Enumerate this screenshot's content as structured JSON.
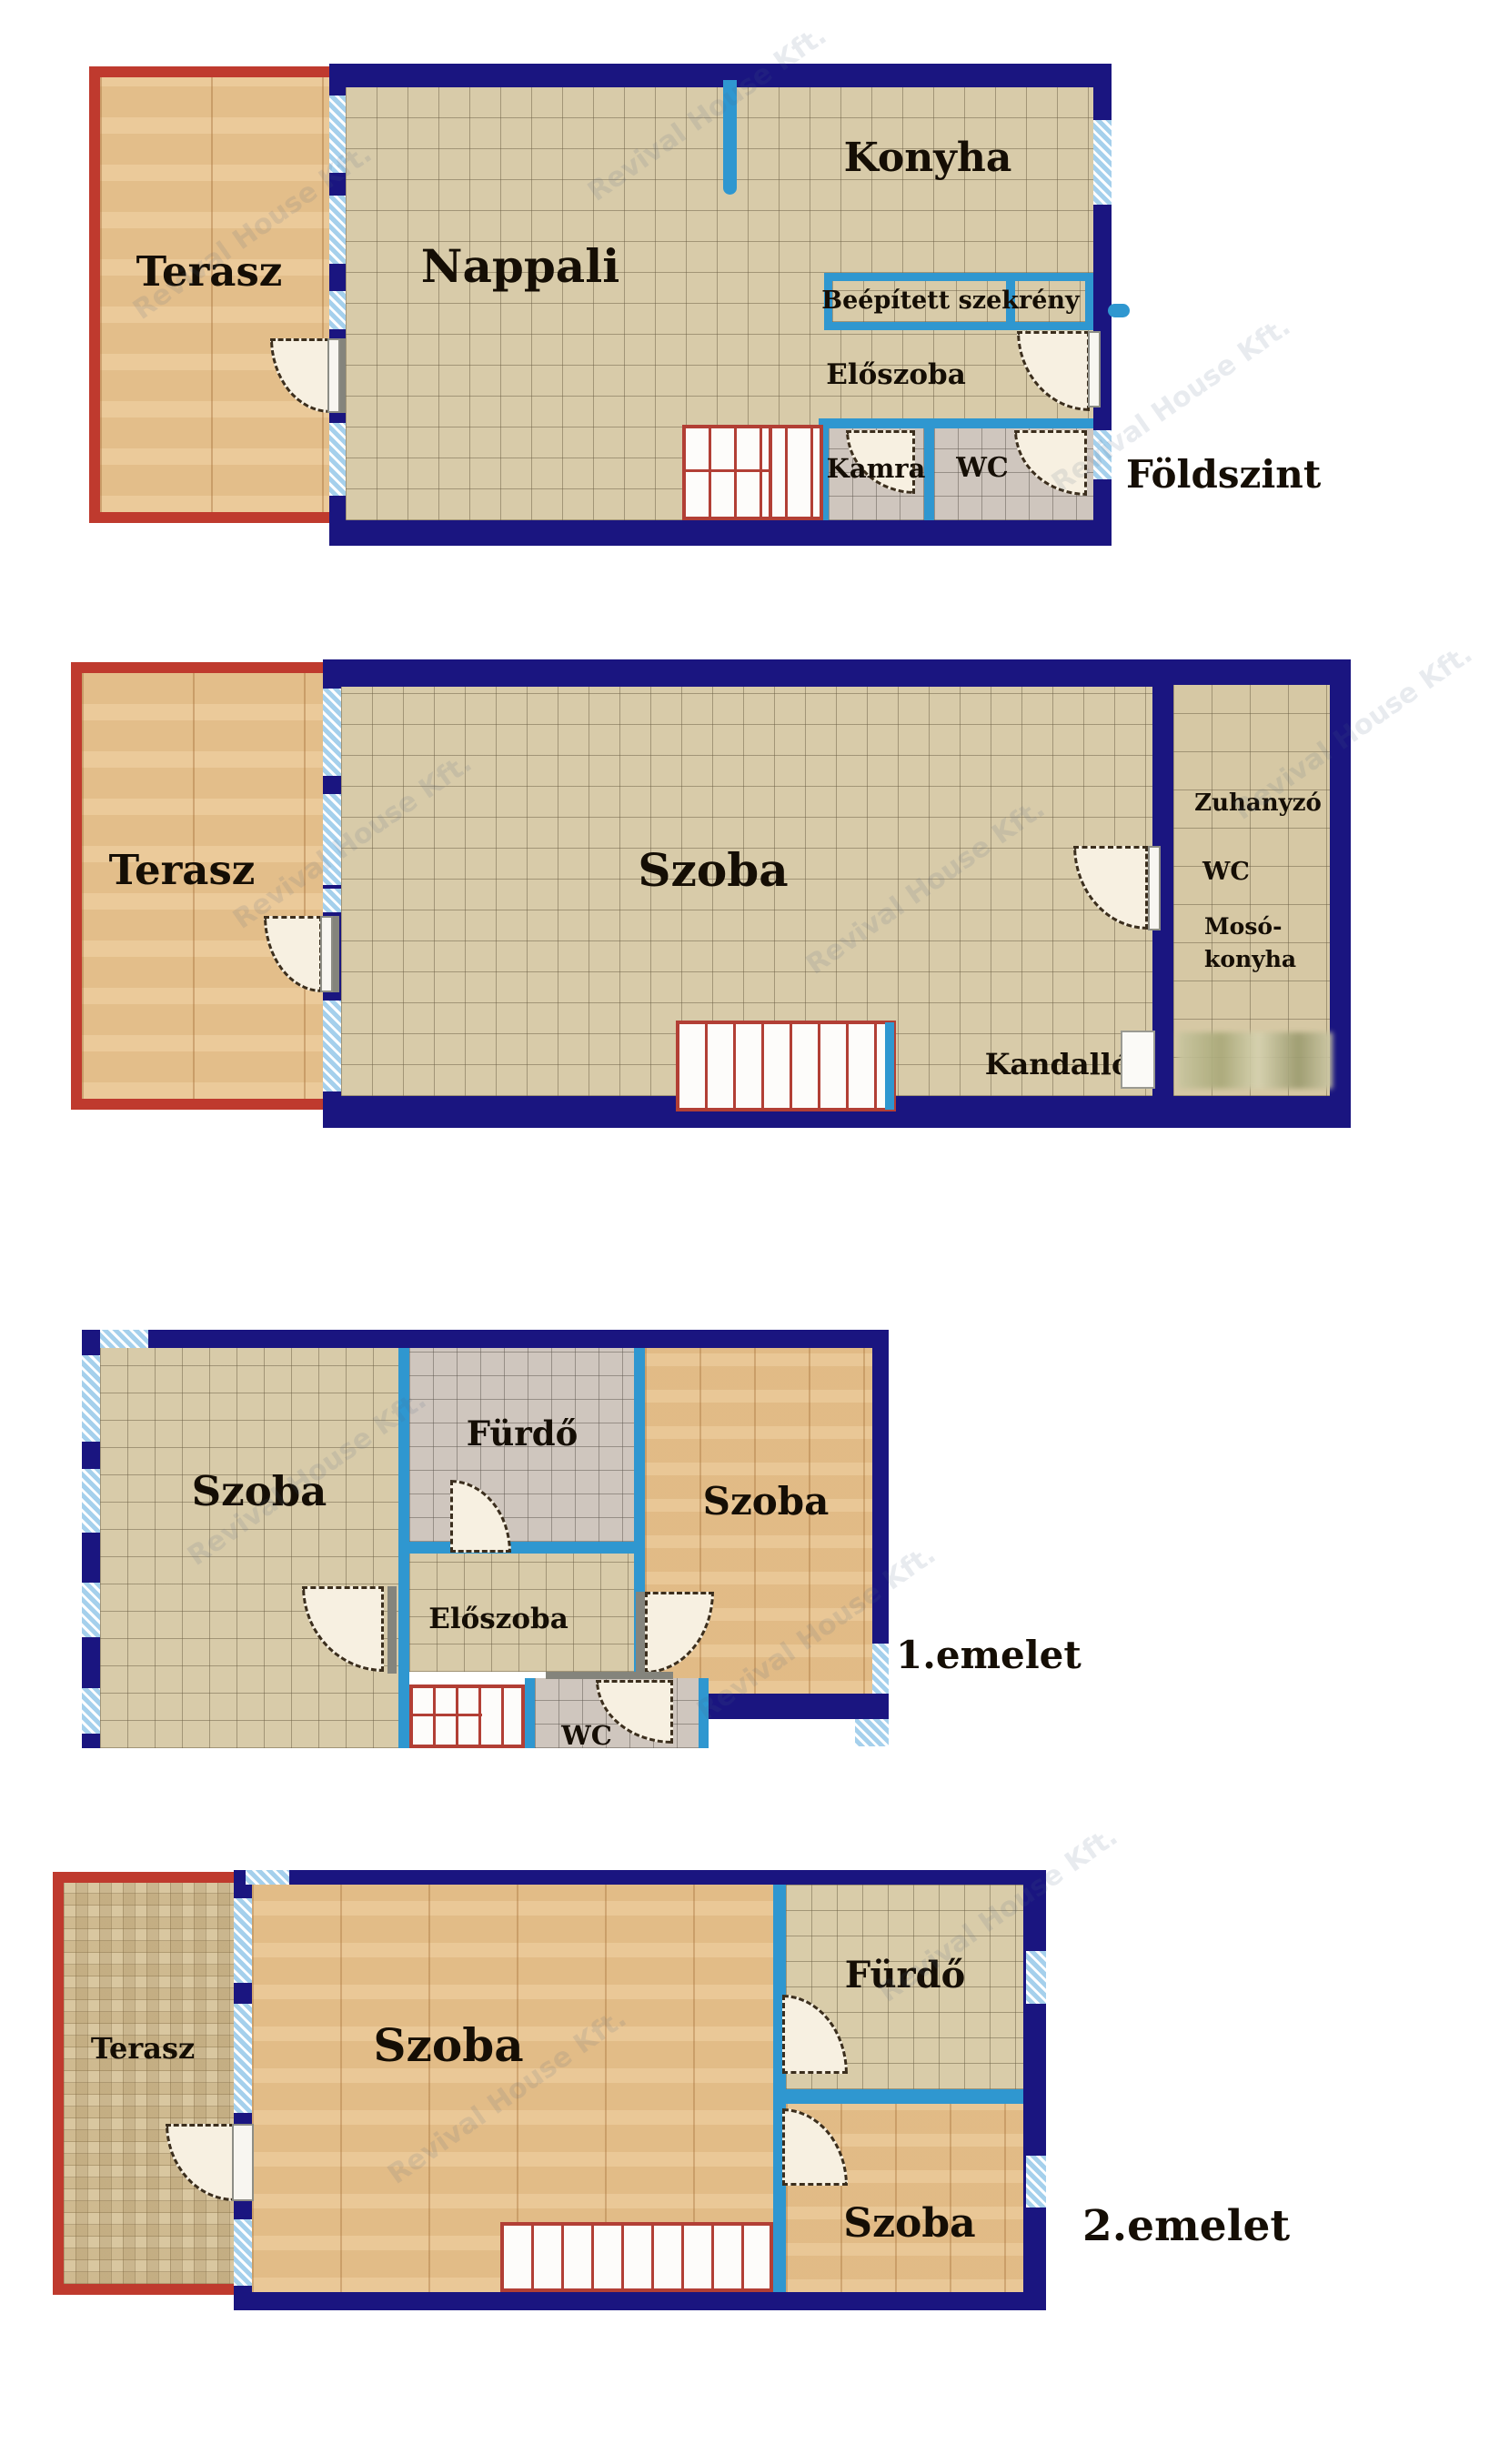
{
  "palette": {
    "outer_wall_navy": "#1a1580",
    "inner_wall_blue": "#2f97d0",
    "terrace_border_red": "#bf3a2e",
    "stairs_red": "#b23f35",
    "tile_beige": "#d8cba9",
    "tile_grey": "#cfc6be",
    "wood": "#e8c28d",
    "window_hatch_blue": "#a5d0ec"
  },
  "watermark": {
    "text": "Revival House Kft."
  },
  "foldszint": {
    "level": "Földszint",
    "terasz": "Terasz",
    "nappali": "Nappali",
    "konyha": "Konyha",
    "szekreny": "Beépített szekrény",
    "eloszoba": "Előszoba",
    "kamra": "Kamra",
    "wc": "WC"
  },
  "szint2": {
    "terasz": "Terasz",
    "szoba": "Szoba",
    "zuhanyzo": "Zuhanyzó",
    "wc": "WC",
    "moso1": "Mosó-",
    "moso2": "konyha",
    "kandallo": "Kandalló"
  },
  "emelet1": {
    "level": "1.emelet",
    "szoba_bal": "Szoba",
    "furdo": "Fürdő",
    "szoba_jobb": "Szoba",
    "eloszoba": "Előszoba",
    "wc": "WC"
  },
  "emelet2": {
    "level": "2.emelet",
    "terasz": "Terasz",
    "szoba_nagy": "Szoba",
    "furdo": "Fürdő",
    "szoba_also": "Szoba"
  }
}
